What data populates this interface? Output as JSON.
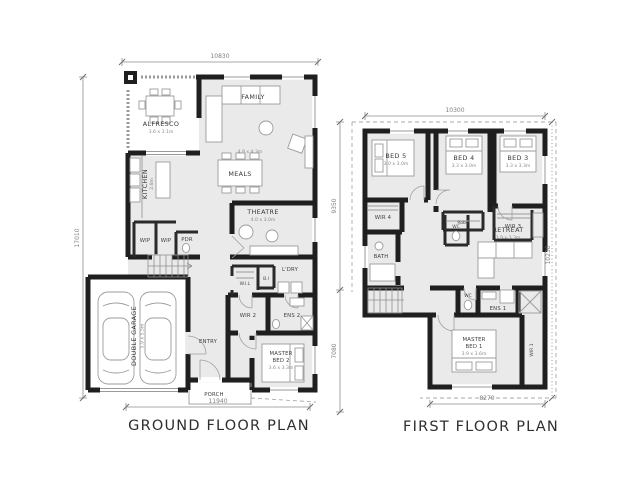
{
  "ground": {
    "title": "GROUND FLOOR PLAN",
    "dim_top": "10830",
    "dim_bottom": "11940",
    "dim_left": "17010",
    "rooms": {
      "alfresco": "ALFRESCO",
      "alfresco_dim": "3.6 x 3.1m",
      "family": "FAMILY",
      "family_dim": "4.9 x 4.3m",
      "kitchen": "KITCHEN",
      "kitchen_dim": "2.6m",
      "meals": "MEALS",
      "theatre": "THEATRE",
      "theatre_dim": "4.0 x 3.0m",
      "wip_a": "WIP",
      "wip_b": "WIP",
      "pdr": "PDR",
      "ldry": "L'DRY",
      "wil": "W.I.L",
      "bi": "B.I",
      "wir2": "WIR 2",
      "ens2": "ENS 2",
      "master_line1": "MASTER",
      "master_line2": "BED 2",
      "master_dim": "3.6 x 3.3m",
      "entry": "ENTRY",
      "porch": "PORCH",
      "garage": "DOUBLE GARAGE",
      "garage_dim": "5.9 x 5.5m"
    }
  },
  "first": {
    "title": "FIRST FLOOR PLAN",
    "dim_top": "10300",
    "dim_bottom": "8270",
    "dim_left_upper": "9350",
    "dim_left_lower": "7080",
    "dim_right": "10230",
    "rooms": {
      "bed5": "BED 5",
      "bed5_dim": "3.0 x 3.0m",
      "bed4": "BED 4",
      "bed4_dim": "3.3 x 3.0m",
      "bed3": "BED 3",
      "bed3_dim": "3.3 x 3.3m",
      "robe": "Robe",
      "wir4": "WIR 4",
      "wir3": "WIR 3",
      "bath": "BATH",
      "wc_upper": "WC",
      "wc_lower": "WC",
      "retreat": "RETREAT",
      "retreat_dim": "3.9 x 3.3m",
      "ens1": "ENS 1",
      "master_line1": "MASTER",
      "master_line2": "BED 1",
      "master_dim": "3.9 x 3.6m",
      "wir1": "WIR 1"
    }
  }
}
